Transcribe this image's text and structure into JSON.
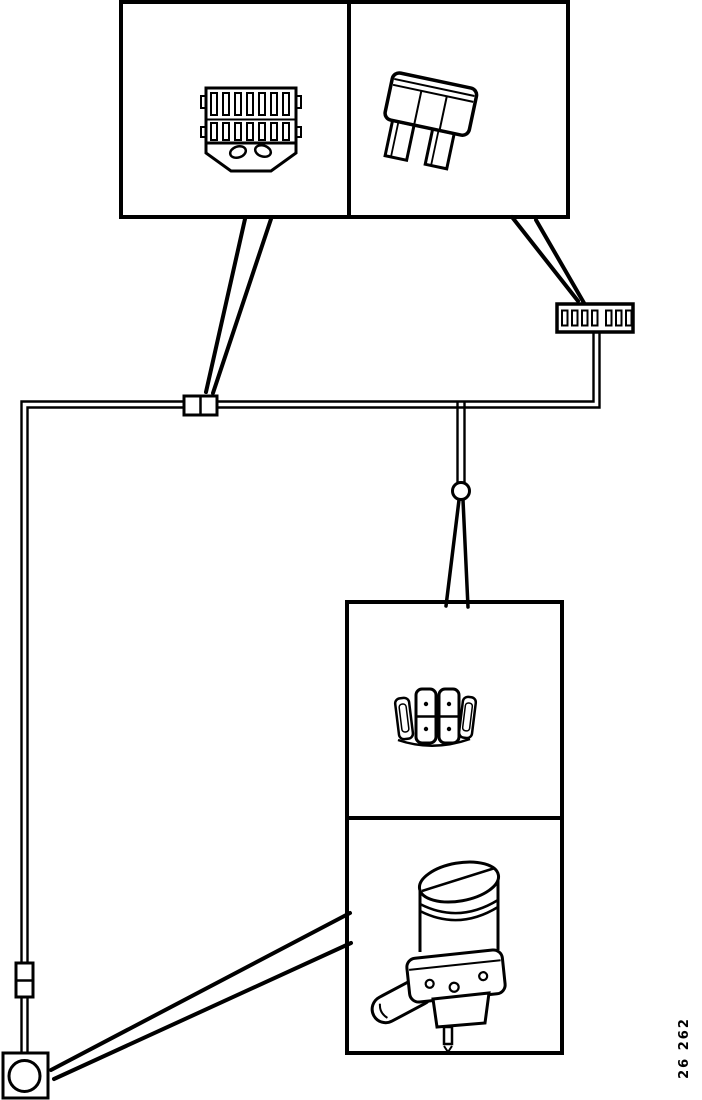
{
  "figure_label": "26 262",
  "colors": {
    "ink": "#000000",
    "paper": "#ffffff"
  },
  "icons": {
    "connector_illustration": "multi-pin-connector",
    "fuse_illustration": "blade-fuse",
    "switch_illustration": "rocker-switch-pack",
    "pump_illustration": "washer-pump-motor",
    "fuse_holder_symbol": "fuse-holder",
    "inline_connector_symbol": "inline-connector",
    "junction_symbol": "wire-junction",
    "ground_symbol": "grounded-connector-box"
  }
}
